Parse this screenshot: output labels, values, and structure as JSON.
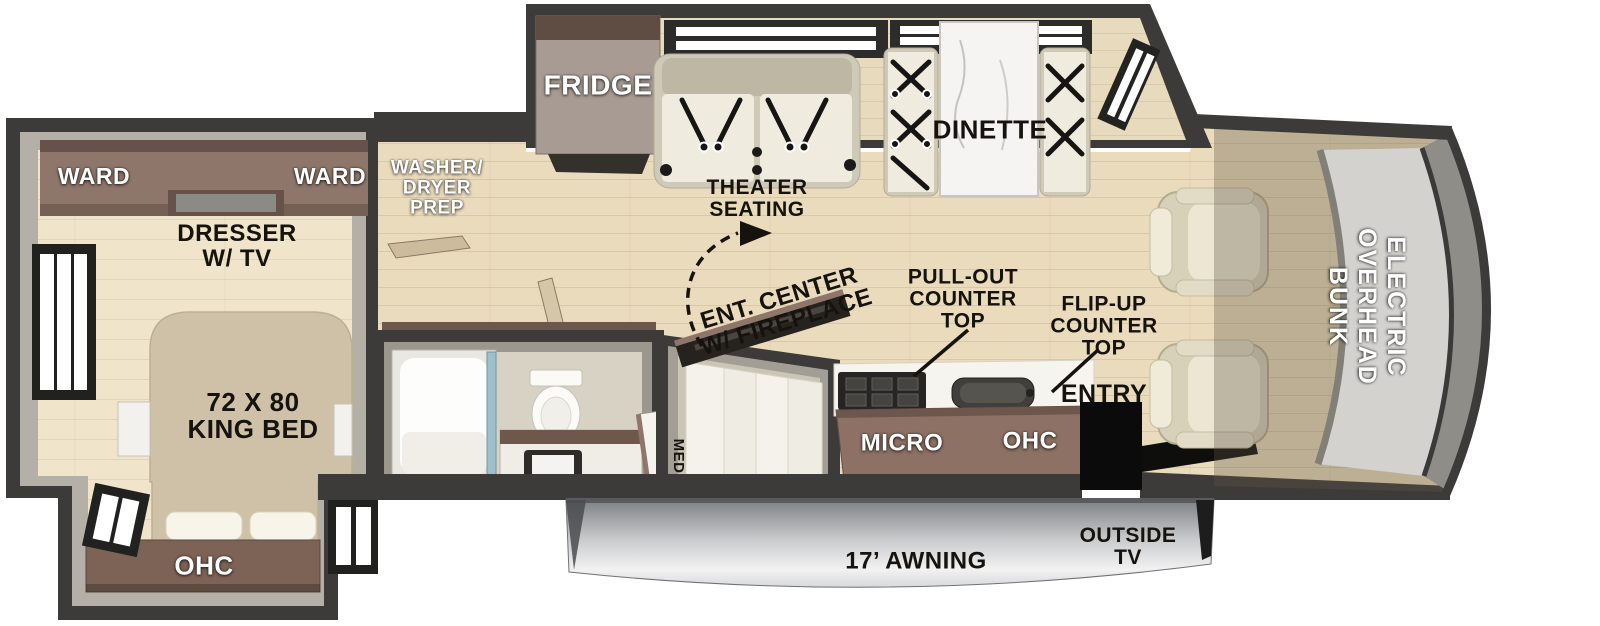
{
  "title": "Motorhome Floor Plan",
  "labels": {
    "ward_left": "WARD",
    "ward_right": "WARD",
    "dresser_tv": "DRESSER\nW/ TV",
    "king_bed": "72 X 80\nKING BED",
    "bedroom_ohc": "OHC",
    "washer_dryer_prep": "WASHER/\nDRYER\nPREP",
    "fridge": "FRIDGE",
    "theater_seating": "THEATER\nSEATING",
    "dinette": "DINETTE",
    "ent_center": "ENT. CENTER\nW/ FIREPLACE",
    "pull_out_counter": "PULL-OUT\nCOUNTER\nTOP",
    "flip_up_counter": "FLIP-UP\nCOUNTER\nTOP",
    "entry": "ENTRY",
    "micro": "MICRO",
    "kitchen_ohc": "OHC",
    "med": "MED",
    "awning": "17’ AWNING",
    "outside_tv": "OUTSIDE\nTV",
    "overhead_bunk": "ELECTRIC\nOVERHEAD\nBUNK"
  },
  "colors": {
    "outline": "#3c3b39",
    "wall": "#b4b0a7",
    "wall_dark": "#9b978e",
    "floor_main": "#eadbbc",
    "floor_bedroom": "#f0e5ca",
    "wood": "#8f766a",
    "wood_dark": "#66524a",
    "cabinet": "#8c7164",
    "counter": "#f6f4ee",
    "appliance_dark": "#2b2a28",
    "bed": "#cfc1a8",
    "cream_seat": "#efecdf",
    "marble": "#f5f4f2",
    "shower_glass": "#9fc0ca",
    "awning_top": "#7e8184",
    "awning_bottom": "#f2f2f3",
    "bunk_fill": "#d3d2cf",
    "bunk_band": "#8f8d88",
    "cab_overlay": "rgba(96,86,68,0.33)",
    "label_dark": "#16130f",
    "label_light": "#ffffff"
  }
}
